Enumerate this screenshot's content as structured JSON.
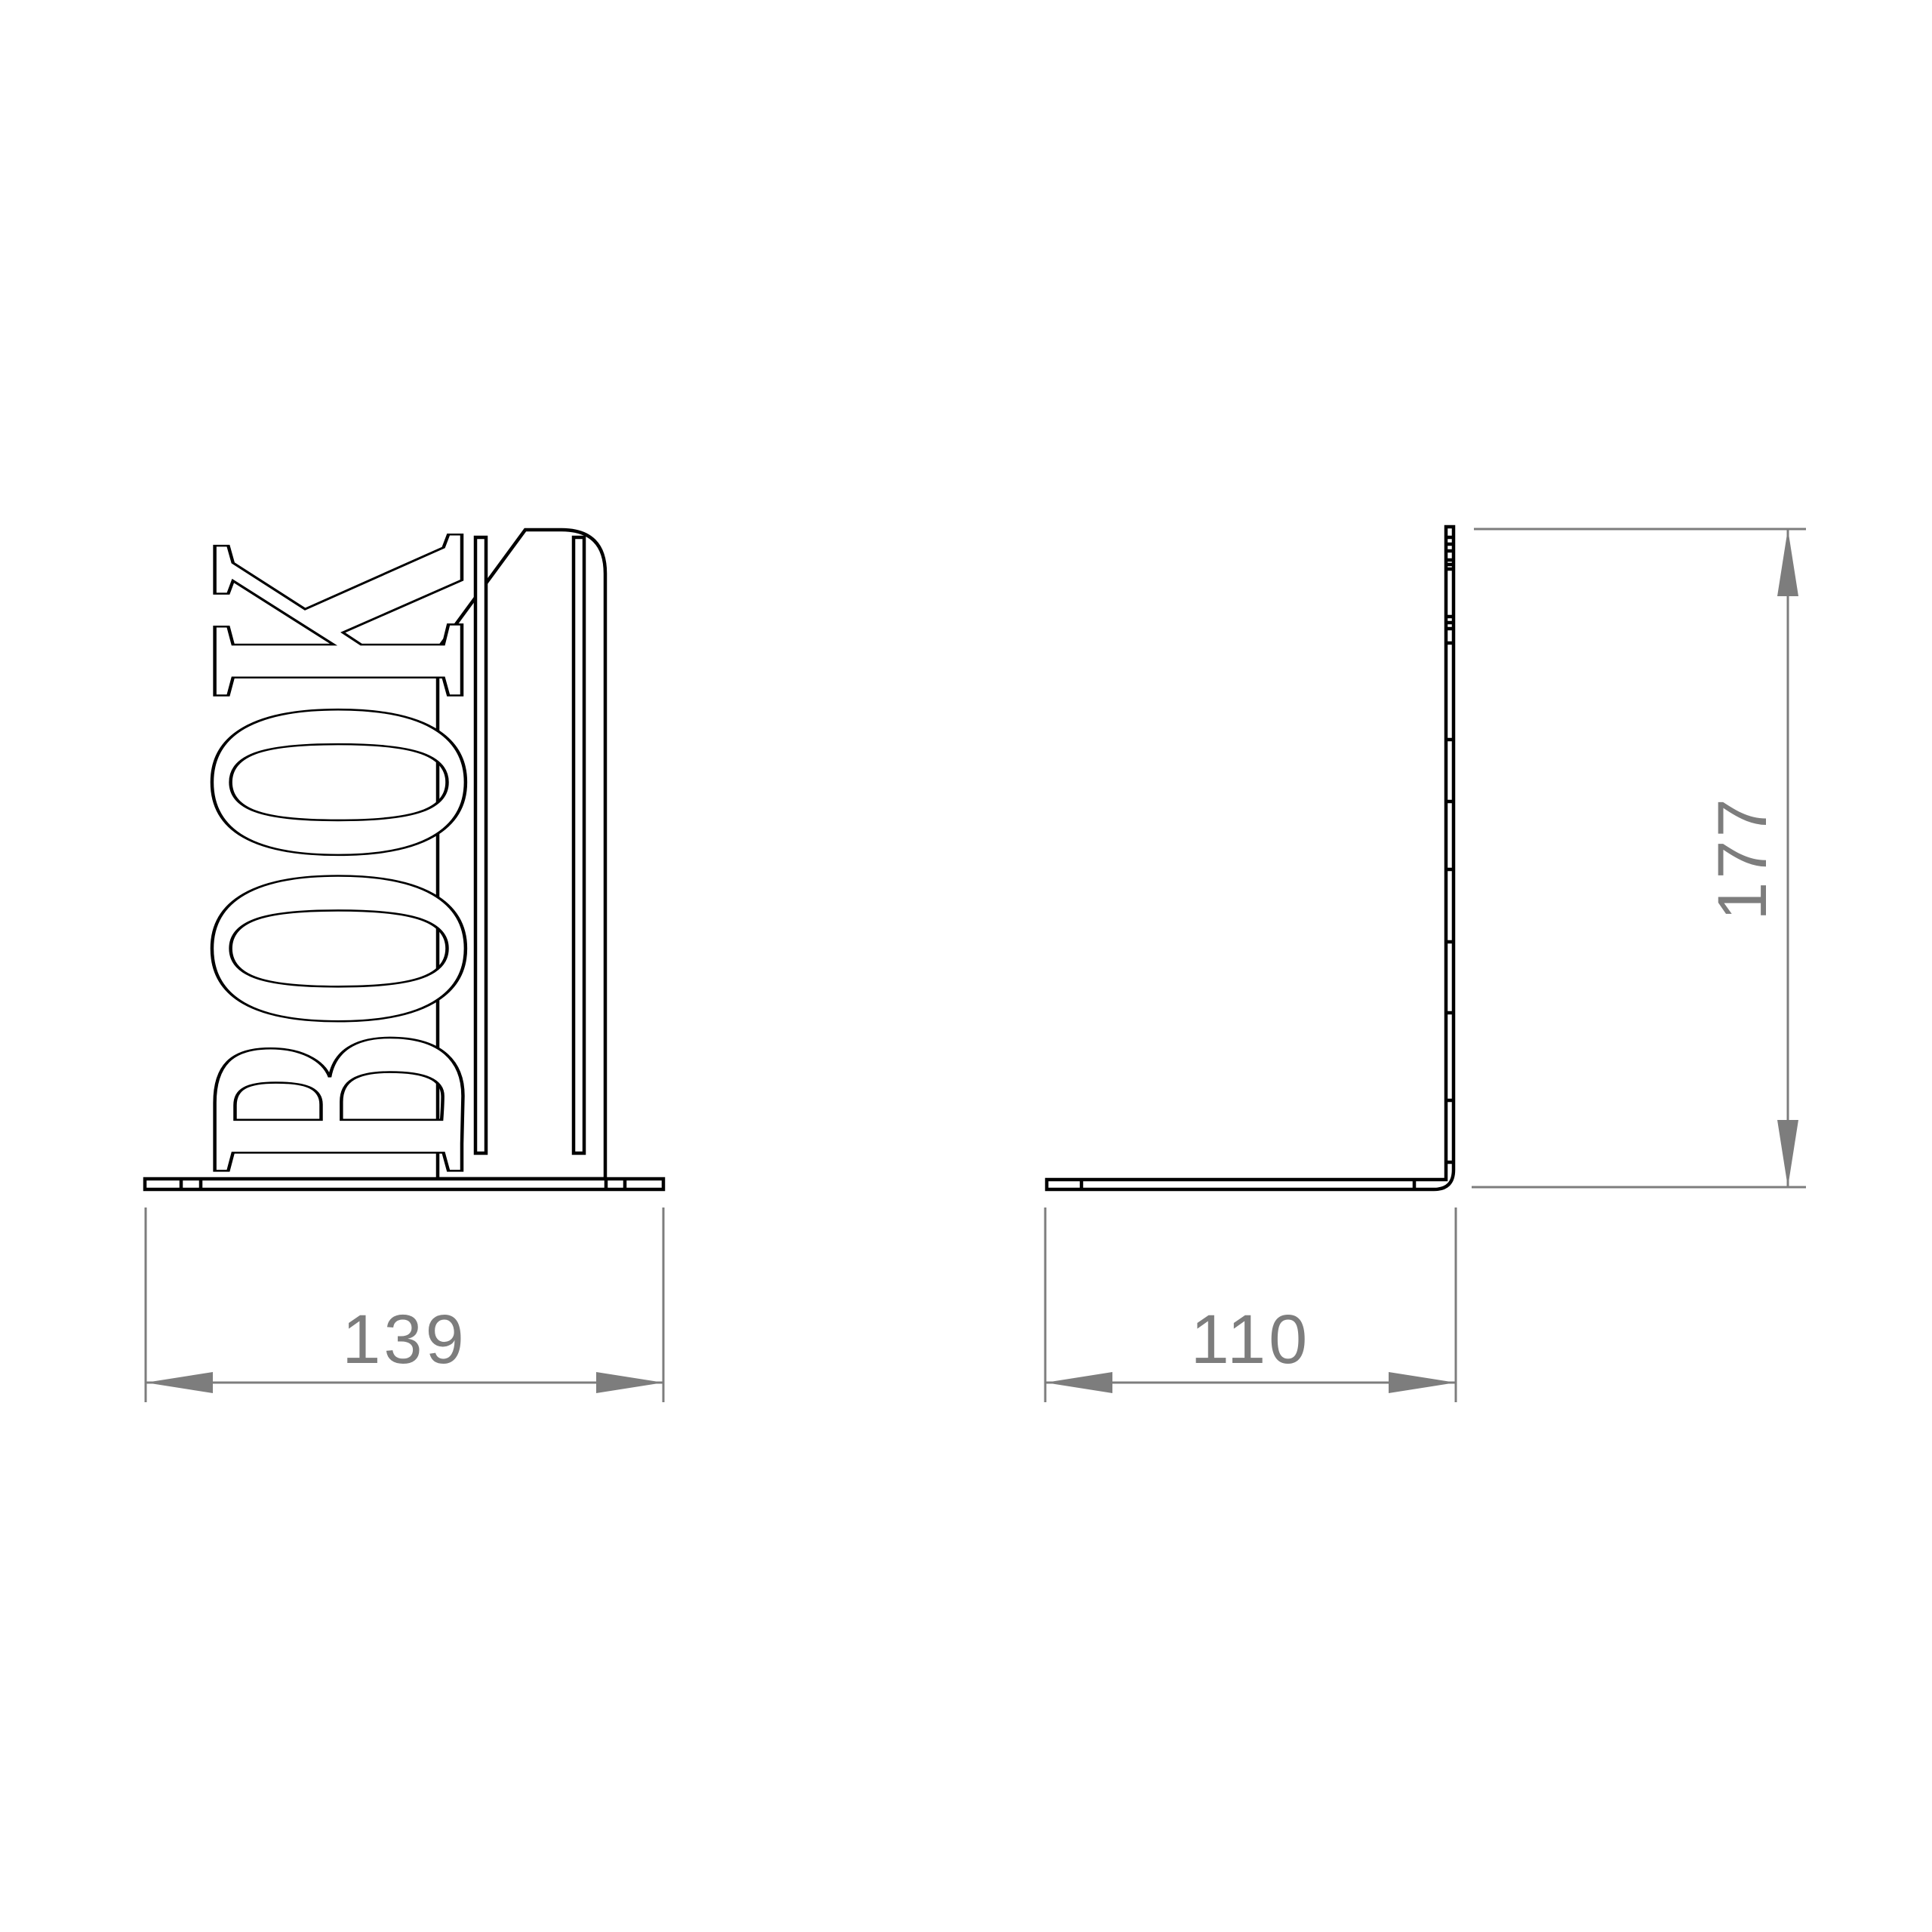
{
  "page": {
    "background_color": "#ffffff"
  },
  "drawing": {
    "kind": "technical-drawing-bookend",
    "line_color": "#000000",
    "dimension_color": "#7d7d7d",
    "front_view": {
      "decorative_text": "BOOK"
    },
    "dimensions": {
      "width": {
        "value": "139"
      },
      "depth": {
        "value": "110"
      },
      "height": {
        "value": "177"
      }
    }
  }
}
